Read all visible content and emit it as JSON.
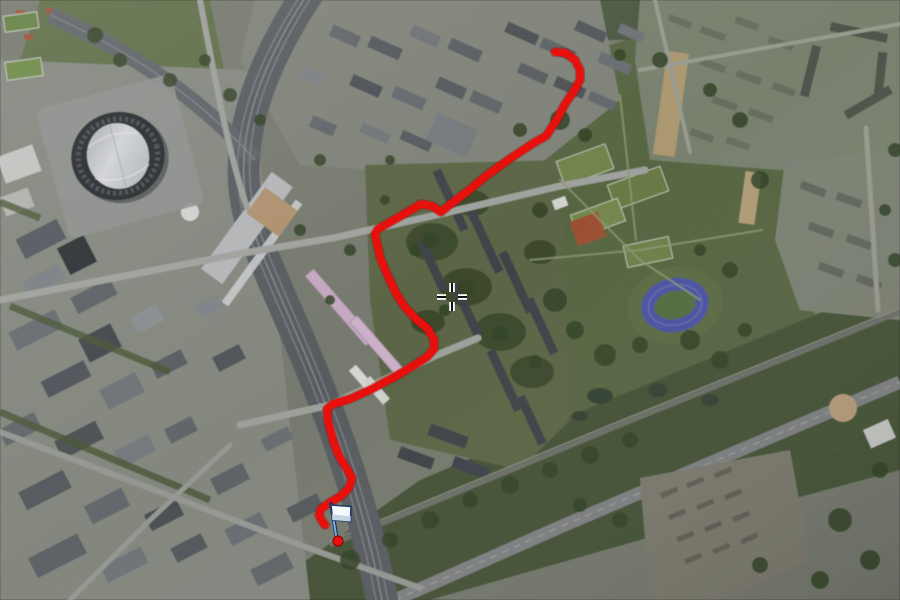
{
  "view": {
    "type": "satellite-map",
    "description": "Aerial satellite view with recorded route overlay, finish flag marker and crosshair cursor",
    "width": 900,
    "height": 600
  },
  "route": {
    "color": "#e8100c",
    "outline_color": "#9c0703",
    "stroke_width": 7.5,
    "points": [
      [
        555,
        52
      ],
      [
        566,
        53
      ],
      [
        575,
        60
      ],
      [
        580,
        70
      ],
      [
        580,
        80
      ],
      [
        574,
        91
      ],
      [
        565,
        104
      ],
      [
        556,
        121
      ],
      [
        546,
        136
      ],
      [
        532,
        144
      ],
      [
        508,
        160
      ],
      [
        486,
        176
      ],
      [
        468,
        191
      ],
      [
        452,
        203
      ],
      [
        441,
        212
      ],
      [
        432,
        206
      ],
      [
        421,
        204
      ],
      [
        399,
        217
      ],
      [
        378,
        229
      ],
      [
        375,
        234
      ],
      [
        380,
        257
      ],
      [
        387,
        274
      ],
      [
        396,
        293
      ],
      [
        404,
        306
      ],
      [
        416,
        319
      ],
      [
        428,
        329
      ],
      [
        434,
        340
      ],
      [
        434,
        349
      ],
      [
        427,
        357
      ],
      [
        413,
        366
      ],
      [
        396,
        376
      ],
      [
        372,
        389
      ],
      [
        350,
        399
      ],
      [
        333,
        404
      ],
      [
        327,
        409
      ],
      [
        328,
        421
      ],
      [
        333,
        440
      ],
      [
        339,
        456
      ],
      [
        347,
        469
      ],
      [
        352,
        478
      ],
      [
        349,
        488
      ],
      [
        341,
        496
      ],
      [
        329,
        503
      ],
      [
        321,
        509
      ],
      [
        319,
        515
      ],
      [
        322,
        521
      ],
      [
        325,
        525
      ]
    ]
  },
  "markers": {
    "endpoint_dot": {
      "x": 338,
      "y": 541,
      "radius": 5,
      "color": "#e8100c",
      "rim_color": "#8c0a06"
    },
    "finish_flag": {
      "x": 338,
      "y": 541,
      "pole_color": "#15366b",
      "pole_highlight": "#82b4e4",
      "flag_fill": "#f5f9fc",
      "flag_shade": "#c3d4e6",
      "flag_outline": "#1d3a63"
    }
  },
  "cursor": {
    "type": "crosshair",
    "x": 452,
    "y": 297,
    "line_color": "#111111",
    "halo_color": "#ffffff"
  },
  "landmarks": [
    {
      "id": "stadium-arena",
      "kind": "stadium"
    },
    {
      "id": "railway-station-corridor",
      "kind": "railway"
    },
    {
      "id": "athletics-track",
      "kind": "sports-track"
    },
    {
      "id": "city-park",
      "kind": "park"
    },
    {
      "id": "pink-roof-buildings",
      "kind": "buildings"
    }
  ],
  "palette": {
    "grass": "#5f7046",
    "urban": "#94988e",
    "forest": "#3a4c2c",
    "rail": "#63676c",
    "road": "#b2b5b0",
    "water": "#3c4a3a",
    "track_blue": "#575fb5",
    "pink_building": "#dcbcd8",
    "silver_platform": "#c9cbcd"
  }
}
